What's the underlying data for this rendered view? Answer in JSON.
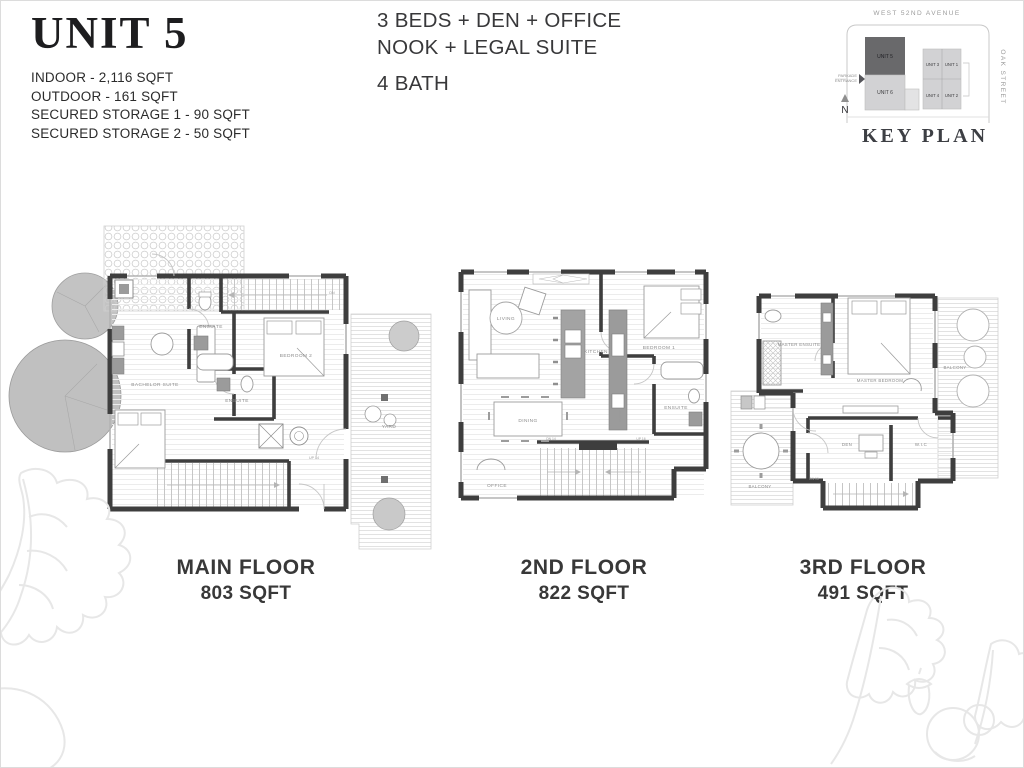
{
  "header": {
    "unit_title": "UNIT 5",
    "stats": [
      "INDOOR - 2,116 SQFT",
      "OUTDOOR - 161 SQFT",
      "SECURED STORAGE 1 - 90 SQFT",
      "SECURED STORAGE 2 - 50 SQFT"
    ],
    "summary_line1": "3 BEDS + DEN + OFFICE",
    "summary_line2": "NOOK + LEGAL SUITE",
    "summary_line3": "4 BATH"
  },
  "key_plan": {
    "title": "KEY PLAN",
    "street_top": "WEST 52ND AVENUE",
    "street_right": "OAK STREET",
    "parkade_line1": "PARKADE",
    "parkade_line2": "ENTRANCE",
    "north_label": "N",
    "unit_highlight": "UNIT 5",
    "unit_below": "UNIT 6",
    "grid_units": [
      "UNIT 3",
      "UNIT 1",
      "UNIT 4",
      "UNIT 2"
    ],
    "highlight_color": "#69696b",
    "unit_fill": "#d2d2d4"
  },
  "floors": [
    {
      "name": "MAIN FLOOR",
      "area": "803 SQFT",
      "rooms": {
        "ensuite_upper": "ENSUITE",
        "bedroom2": "BEDROOM 2",
        "bachelor_suite": "BACHELOR SUITE",
        "ensuite_lower": "ENSUITE",
        "yard": "YARD",
        "stairs_up": "UP 14",
        "stairs_dn": "DN"
      }
    },
    {
      "name": "2ND FLOOR",
      "area": "822 SQFT",
      "rooms": {
        "living": "LIVING",
        "kitchen": "KITCHEN",
        "bedroom1": "BEDROOM 1",
        "ensuite": "ENSUITE",
        "pantry": "PANTRY",
        "dining": "DINING",
        "office": "OFFICE",
        "stairs_dn": "DN 14",
        "stairs_up": "UP 16"
      }
    },
    {
      "name": "3RD FLOOR",
      "area": "491 SQFT",
      "rooms": {
        "master_ensuite": "MASTER ENSUITE",
        "master_bedroom": "MASTER BEDROOM",
        "balcony_right": "BALCONY",
        "den": "DEN",
        "wic": "W.I.C",
        "balcony_left": "BALCONY",
        "stairs_dn": "DN 16"
      }
    }
  ]
}
